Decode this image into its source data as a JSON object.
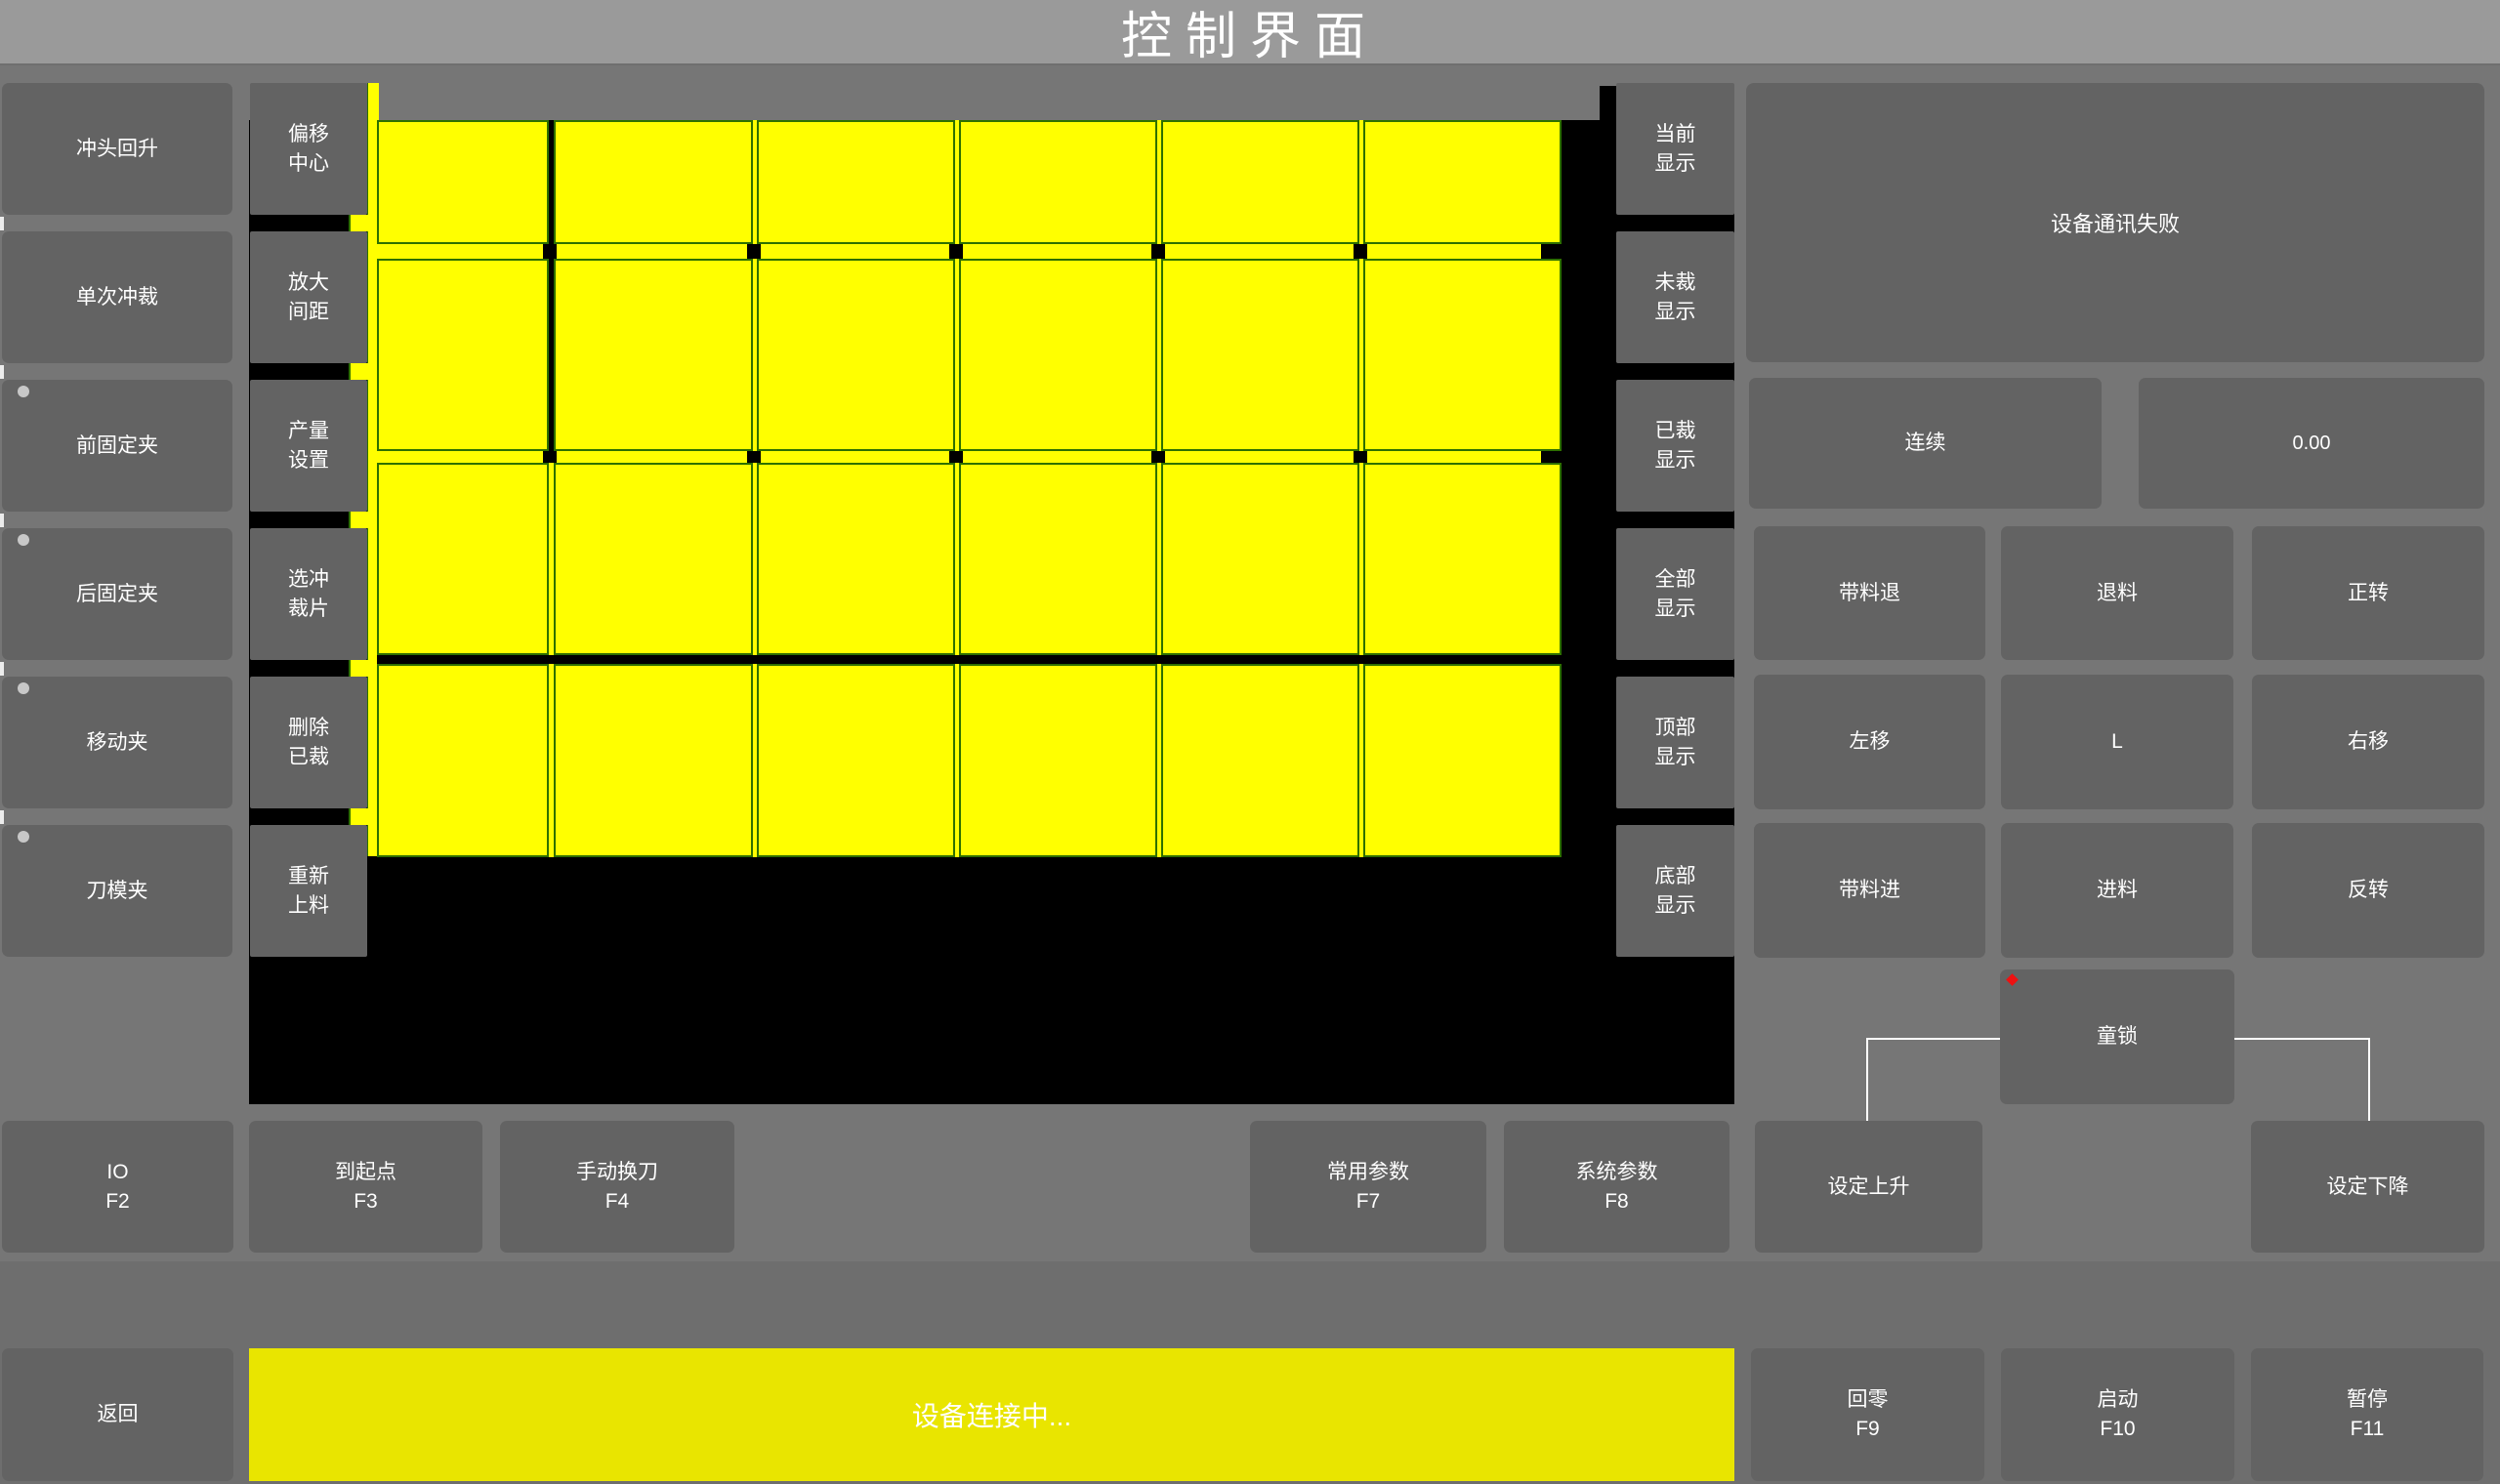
{
  "title": "控制界面",
  "colors": {
    "background": "#767676",
    "bottom_background": "#6e6e6e",
    "titlebar": "#9a9a9a",
    "button": "#636363",
    "canvas": "#000000",
    "piece_yellow": "#ffff00",
    "piece_border_green": "#2e7000",
    "status_bar_yellow": "#e9e500",
    "text": "#ffffff",
    "indicator_dot": "#c8c8c8",
    "alarm_dot": "#ee1111"
  },
  "left_panel": {
    "buttons": [
      {
        "label": "冲头回升",
        "indicator": false
      },
      {
        "label": "单次冲裁",
        "indicator": false
      },
      {
        "label": "前固定夹",
        "indicator": true
      },
      {
        "label": "后固定夹",
        "indicator": true
      },
      {
        "label": "移动夹",
        "indicator": true
      },
      {
        "label": "刀模夹",
        "indicator": true
      }
    ]
  },
  "tool_panel": {
    "buttons": [
      {
        "line1": "偏移",
        "line2": "中心"
      },
      {
        "line1": "放大",
        "line2": "间距"
      },
      {
        "line1": "产量",
        "line2": "设置"
      },
      {
        "line1": "选冲",
        "line2": "裁片"
      },
      {
        "line1": "删除",
        "line2": "已裁"
      },
      {
        "line1": "重新",
        "line2": "上料"
      }
    ]
  },
  "display_panel": {
    "buttons": [
      {
        "line1": "当前",
        "line2": "显示"
      },
      {
        "line1": "未裁",
        "line2": "显示"
      },
      {
        "line1": "已裁",
        "line2": "显示"
      },
      {
        "line1": "全部",
        "line2": "显示"
      },
      {
        "line1": "顶部",
        "line2": "显示"
      },
      {
        "line1": "底部",
        "line2": "显示"
      }
    ]
  },
  "nest_view": {
    "type": "nesting-preview",
    "rows": 4,
    "columns": 6,
    "piece_state": "uncut"
  },
  "status_panel": {
    "message": "设备通讯失败",
    "mode_button": "连续",
    "value": "0.00",
    "jog_buttons": [
      "带料退",
      "退料",
      "正转",
      "左移",
      "L",
      "右移",
      "带料进",
      "进料",
      "反转"
    ],
    "child_lock": "童锁"
  },
  "function_row": [
    {
      "label": "IO",
      "key": "F2"
    },
    {
      "label": "到起点",
      "key": "F3"
    },
    {
      "label": "手动换刀",
      "key": "F4"
    },
    {
      "label": "常用参数",
      "key": "F7"
    },
    {
      "label": "系统参数",
      "key": "F8"
    },
    {
      "label": "设定上升",
      "key": ""
    },
    {
      "label": "设定下降",
      "key": ""
    }
  ],
  "bottom_bar": {
    "back": "返回",
    "status": "设备连接中...",
    "buttons": [
      {
        "label": "回零",
        "key": "F9"
      },
      {
        "label": "启动",
        "key": "F10"
      },
      {
        "label": "暂停",
        "key": "F11"
      }
    ]
  }
}
